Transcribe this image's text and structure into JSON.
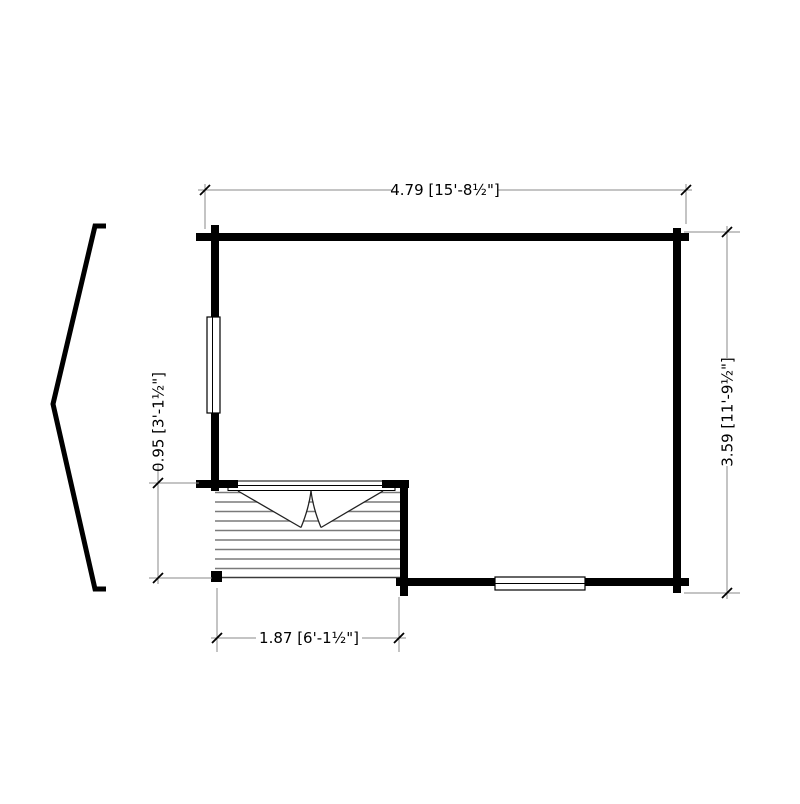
{
  "plan": {
    "dimensions": {
      "top": "4.79 [15'-8½\"]",
      "right": "3.59 [11'-9½\"]",
      "left": "0.95 [3'-1½\"]",
      "bottom": "1.87 [6'-1½\"]"
    },
    "colors": {
      "wall": "#000000",
      "dimension_line": "#8a8a8a",
      "deck_board": "#7a7a7a",
      "background": "#ffffff",
      "text": "#000000"
    }
  }
}
